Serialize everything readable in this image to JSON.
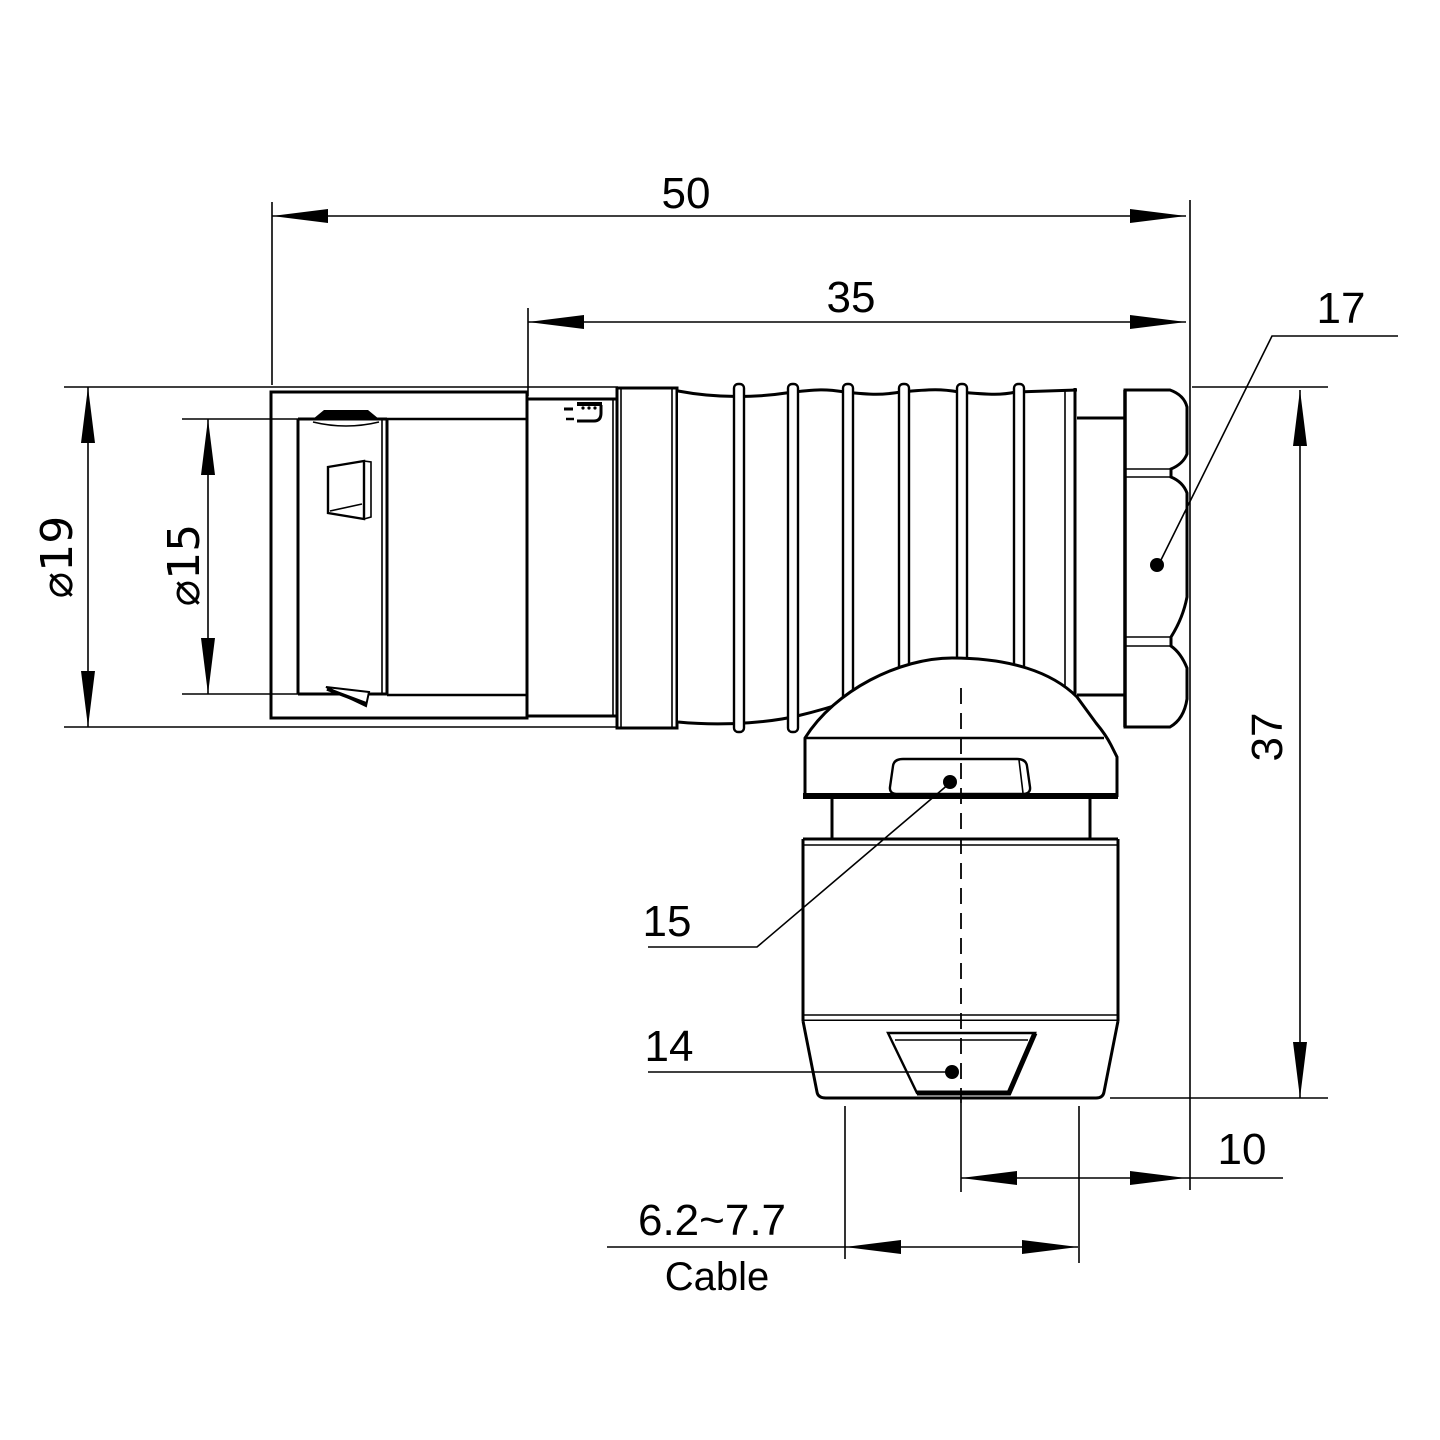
{
  "drawing": {
    "ink": "#000000",
    "background": "#ffffff",
    "description": "Right-angle circular connector elbow plug, dimensioned side view"
  },
  "watermark": {
    "text": "Lightany",
    "color": "#f5d6d6"
  },
  "labels": {
    "overall_length": "50",
    "boot_length": "35",
    "hex_flat": "17",
    "outer_diameter": "⌀19",
    "inner_diameter": "⌀15",
    "height": "37",
    "gland_ref": "15",
    "nut_ref": "14",
    "offset": "10",
    "cable_range": "6.2~7.7",
    "cable_word": "Cable"
  }
}
